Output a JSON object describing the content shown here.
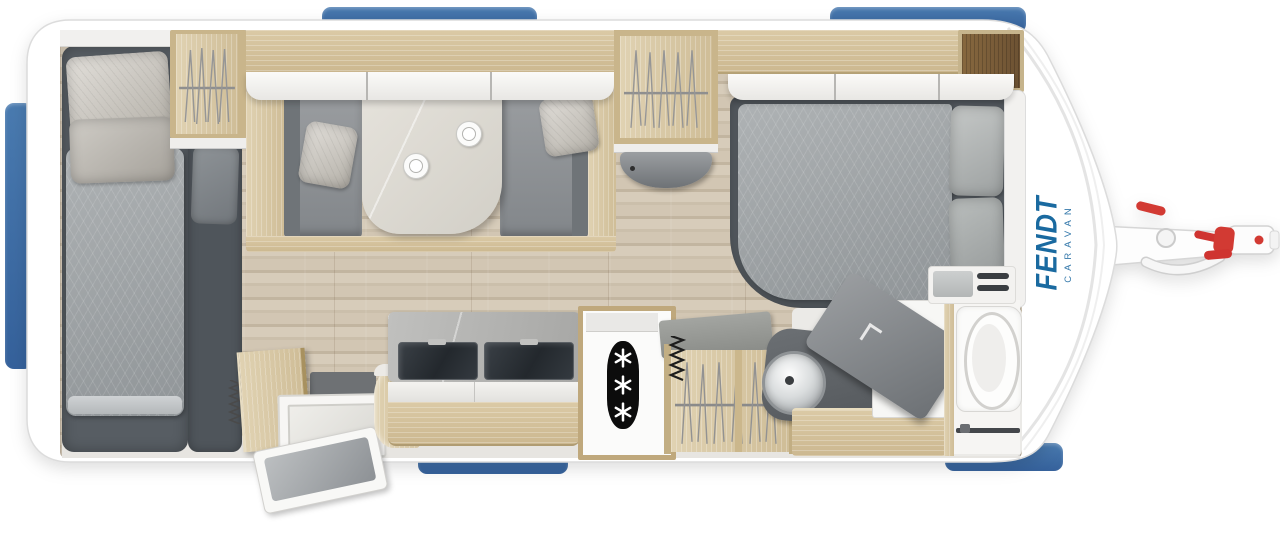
{
  "title": "Caravan floor plan top view",
  "brand": {
    "name": "FENDT",
    "sub": "CARAVAN"
  },
  "logo": {
    "color_primary": "#1a6aa0",
    "color_secondary": "#3579ab"
  },
  "accents": {
    "window_blue": "#3c6da4",
    "hitch_red": "#d23a33",
    "shell_white": "#ffffff"
  },
  "fridge": {
    "icon": "snowflake-icon",
    "snowflake_count": 3
  },
  "icons": [
    "snowflake-icon",
    "coffee-cup-icon",
    "clothes-hanger-icon",
    "washbasin-icon",
    "toilet-icon",
    "hitch-icon"
  ],
  "materials": {
    "floor_wood": "#cbbfab",
    "furniture_wood": "#d5c3a0",
    "fabric_gray": "#9fa4a7",
    "base_gray": "#575d63"
  }
}
